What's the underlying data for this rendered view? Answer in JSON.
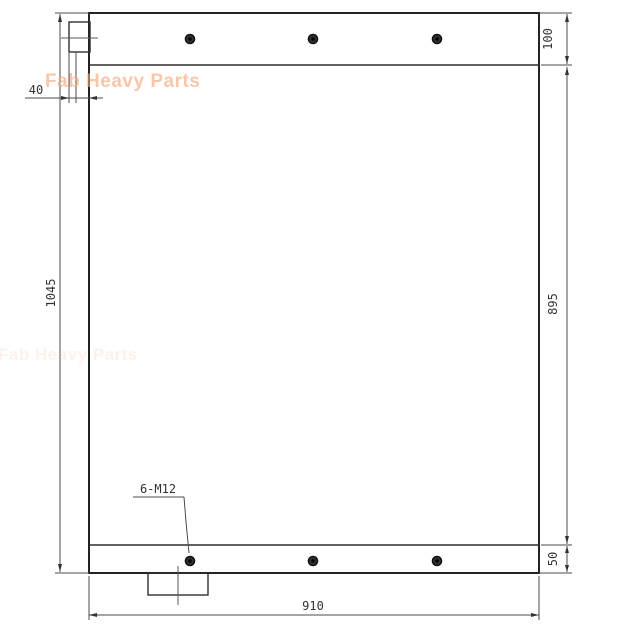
{
  "watermark": {
    "text": "Fab Heavy Parts",
    "color": "#f5a678"
  },
  "dimensions": {
    "top_flange_height": "100",
    "left_tab_offset": "40",
    "overall_height": "1045",
    "core_height": "895",
    "bottom_flange_height": "50",
    "overall_width": "910",
    "mounting_holes_callout": "6-M12"
  },
  "style": {
    "outline_color": "#232323",
    "dimension_color": "#4b4b4b",
    "text_color": "#333333",
    "background": "#ffffff"
  }
}
